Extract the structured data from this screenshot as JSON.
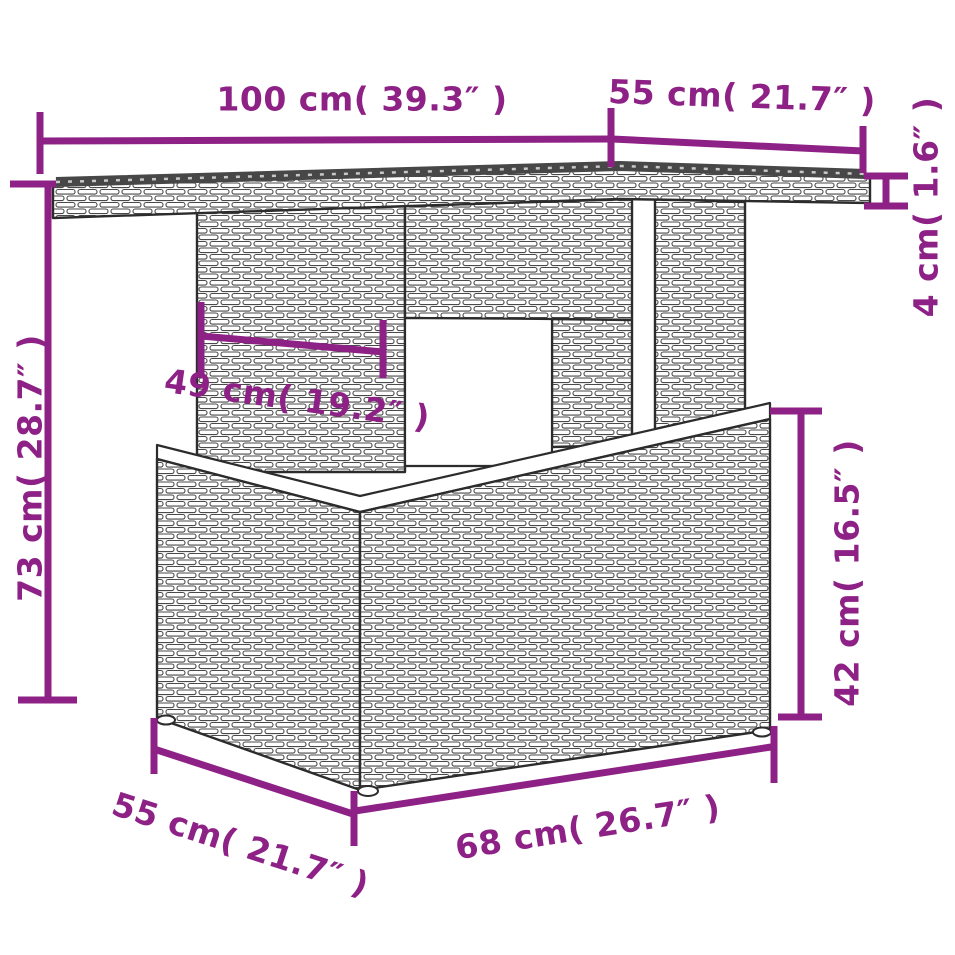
{
  "page": {
    "type": "product-dimension-diagram",
    "subject": "poly-rattan garden table",
    "background": "#ffffff"
  },
  "colors": {
    "dimension_accent": "#8e2186",
    "drawing_outline": "#2c2c2c",
    "glass_top": "#474747"
  },
  "dimensions": {
    "top_length": {
      "label": "100 cm( 39.3″ )",
      "value_cm": 100,
      "value_in": 39.3
    },
    "top_depth": {
      "label": "55 cm( 21.7″ )",
      "value_cm": 55,
      "value_in": 21.7
    },
    "top_thickness": {
      "label": "4 cm( 1.6″ )",
      "value_cm": 4,
      "value_in": 1.6
    },
    "overall_height": {
      "label": "73 cm( 28.7″ )",
      "value_cm": 73,
      "value_in": 28.7
    },
    "pedestal_width": {
      "label": "49 cm( 19.2″ )",
      "value_cm": 49,
      "value_in": 19.2
    },
    "base_height": {
      "label": "42 cm( 16.5″ )",
      "value_cm": 42,
      "value_in": 16.5
    },
    "base_depth": {
      "label": "55 cm( 21.7″ )",
      "value_cm": 55,
      "value_in": 21.7
    },
    "base_length": {
      "label": "68 cm( 26.7″ )",
      "value_cm": 68,
      "value_in": 26.7
    }
  }
}
